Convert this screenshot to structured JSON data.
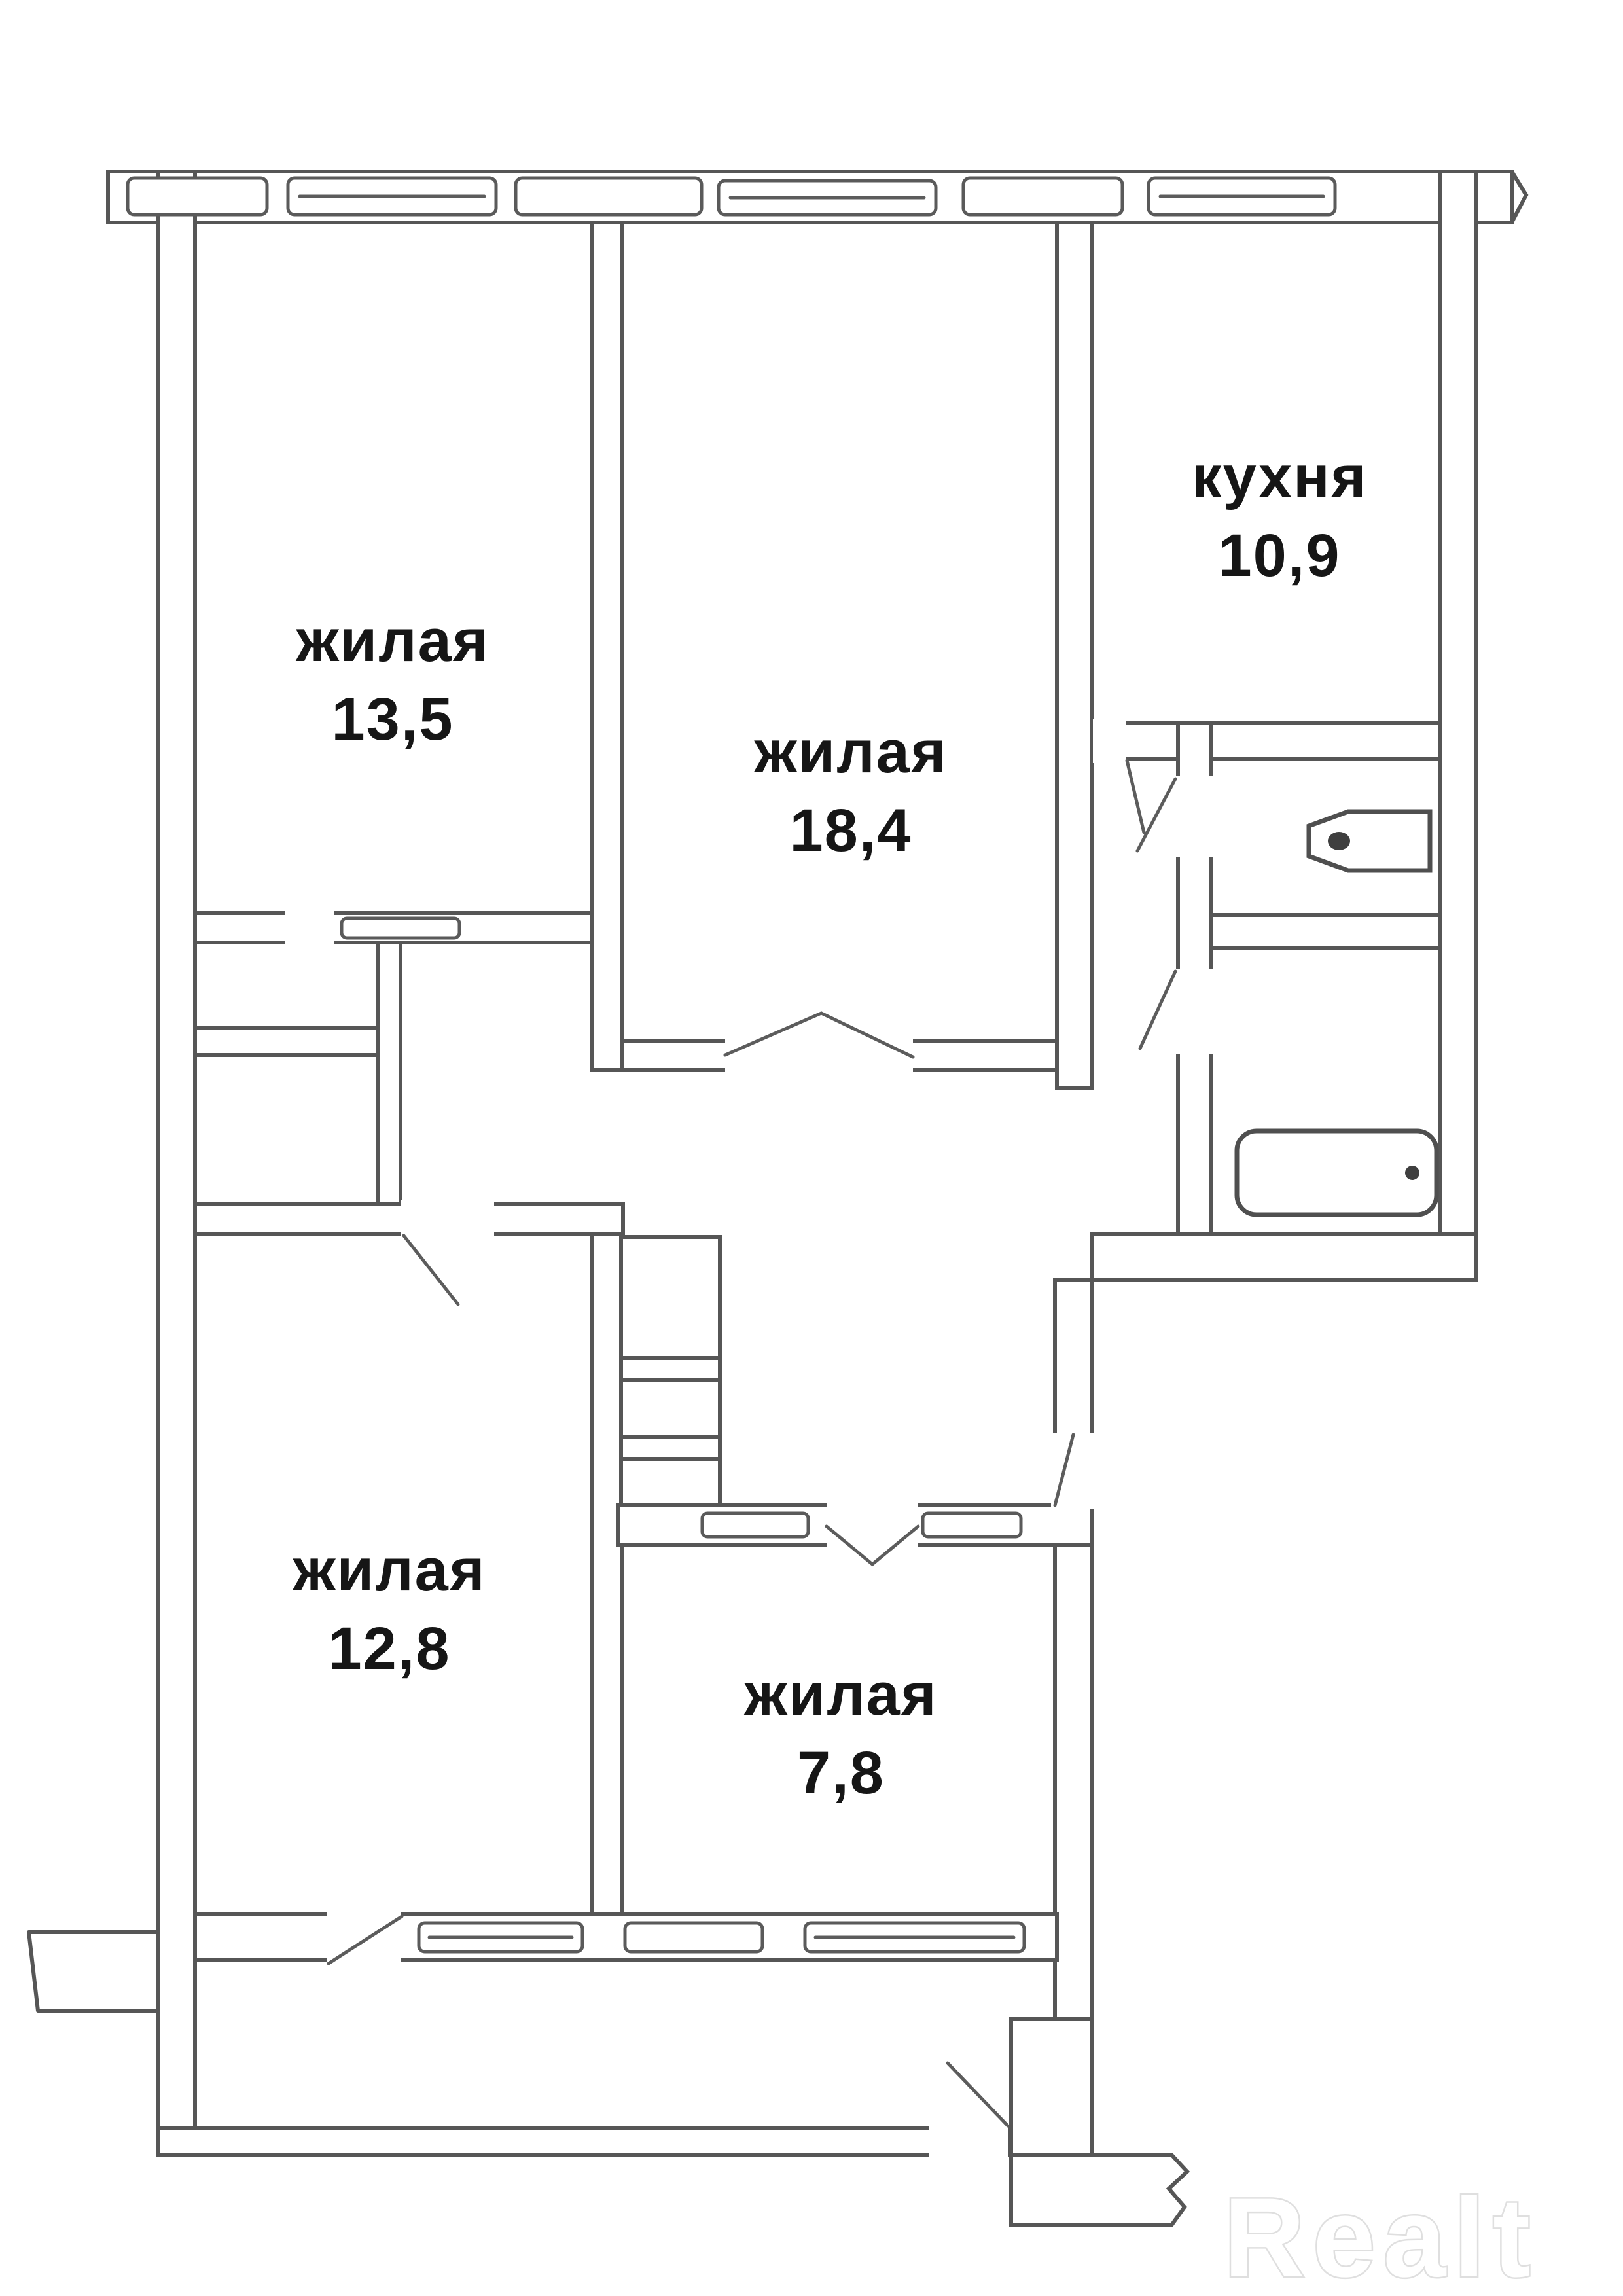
{
  "plan": {
    "watermark": "Realt",
    "rooms": [
      {
        "name": "жилая",
        "area": "13,5"
      },
      {
        "name": "жилая",
        "area": "18,4"
      },
      {
        "name": "кухня",
        "area": "10,9"
      },
      {
        "name": "жилая",
        "area": "12,8"
      },
      {
        "name": "жилая",
        "area": "7,8"
      }
    ],
    "icons": [
      "toilet-icon",
      "bathtub-icon"
    ],
    "colors": {
      "wall_line": "#565656",
      "label_text": "#161616",
      "watermark_fill": "#ffffff",
      "watermark_outline": "#dfdfdf"
    }
  }
}
